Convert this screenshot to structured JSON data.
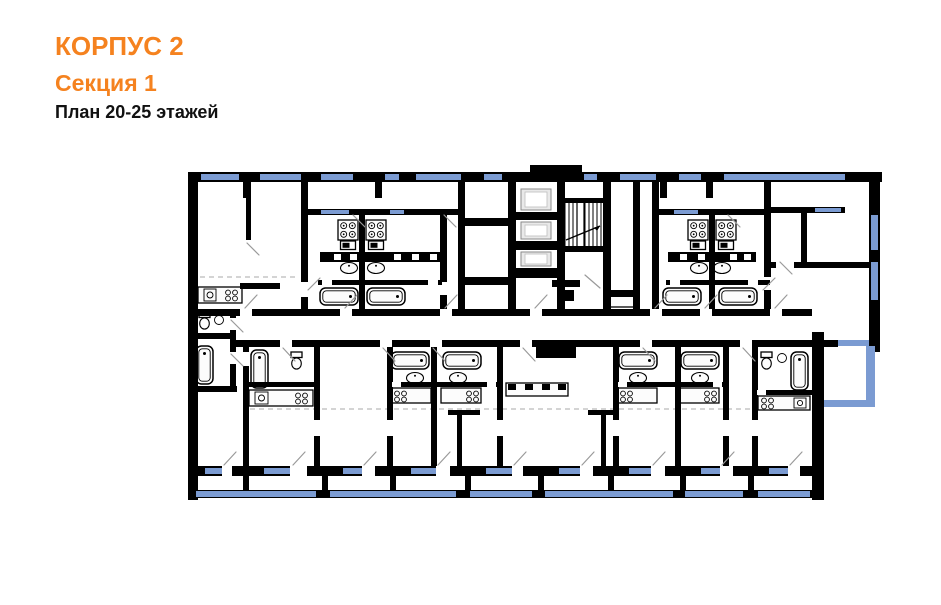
{
  "header": {
    "building": "КОРПУС 2",
    "section": "Секция 1",
    "floors": "План 20-25 этажей"
  },
  "colors": {
    "accent": "#F5821F",
    "wall": "#000000",
    "window": "#7B9BD2",
    "swing": "#9A9A9A",
    "dash": "#A8A8A8",
    "fixture_fill": "#FCFCFC",
    "elevator_fill": "#E9E9E9",
    "text": "#111111",
    "background": "#FFFFFF"
  },
  "plan": {
    "type": "residential-floor-plan",
    "icons": [
      "exterior-walls",
      "window-strips",
      "balconies",
      "staircase",
      "elevator-shafts",
      "kitchen-stove-icon",
      "kitchen-counter-icon",
      "bathtub-icon",
      "sink-icon",
      "toilet-icon",
      "door-swing-lines",
      "dashed-zoning-lines"
    ]
  }
}
